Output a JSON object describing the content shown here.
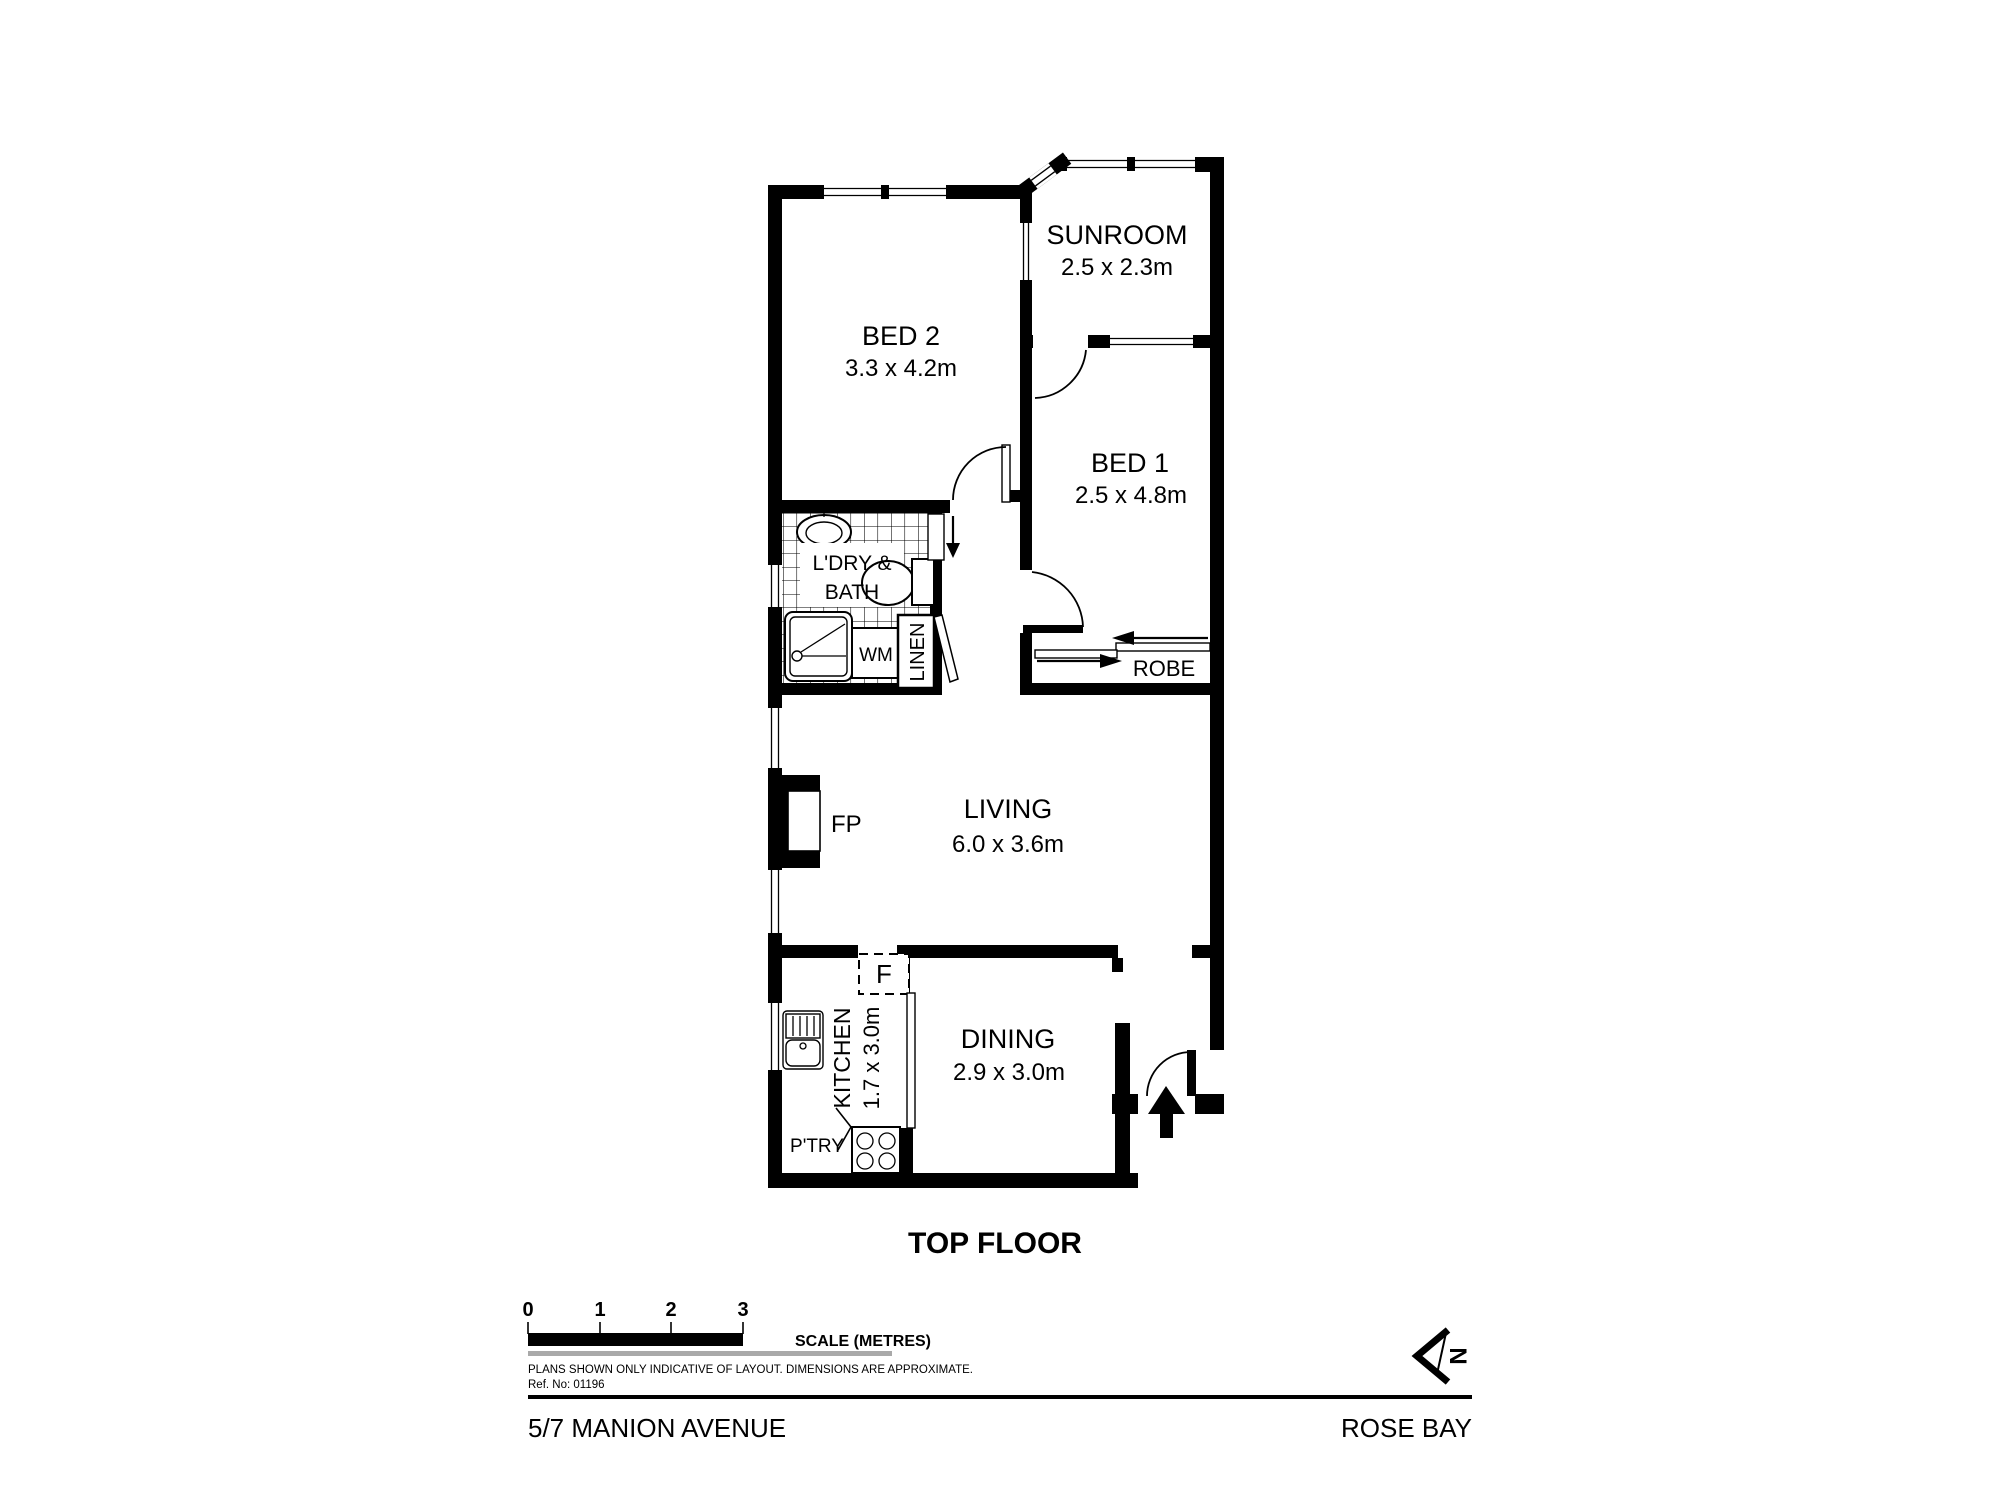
{
  "floorplan": {
    "level_title": "TOP FLOOR",
    "address": "5/7 MANION AVENUE",
    "suburb": "ROSE BAY",
    "north_label": "N",
    "rooms": {
      "bed2": {
        "name": "BED 2",
        "dims": "3.3 x 4.2m"
      },
      "sunroom": {
        "name": "SUNROOM",
        "dims": "2.5 x 2.3m"
      },
      "bed1": {
        "name": "BED 1",
        "dims": "2.5 x 4.8m"
      },
      "living": {
        "name": "LIVING",
        "dims": "6.0 x 3.6m"
      },
      "dining": {
        "name": "DINING",
        "dims": "2.9 x 3.0m"
      },
      "kitchen": {
        "name": "KITCHEN",
        "dims": "1.7 x 3.0m"
      },
      "bath": {
        "name_line1": "L'DRY &",
        "name_line2": "BATH"
      }
    },
    "features": {
      "washing_machine": "WM",
      "linen": "LINEN",
      "robe": "ROBE",
      "fireplace": "FP",
      "fridge": "F",
      "pantry": "P'TRY"
    }
  },
  "scale_bar": {
    "ticks": [
      "0",
      "1",
      "2",
      "3"
    ],
    "unit_label": "SCALE (METRES)",
    "disclaimer": "PLANS SHOWN ONLY INDICATIVE OF LAYOUT.  DIMENSIONS ARE APPROXIMATE.",
    "reference": "Ref. No: 01196"
  }
}
